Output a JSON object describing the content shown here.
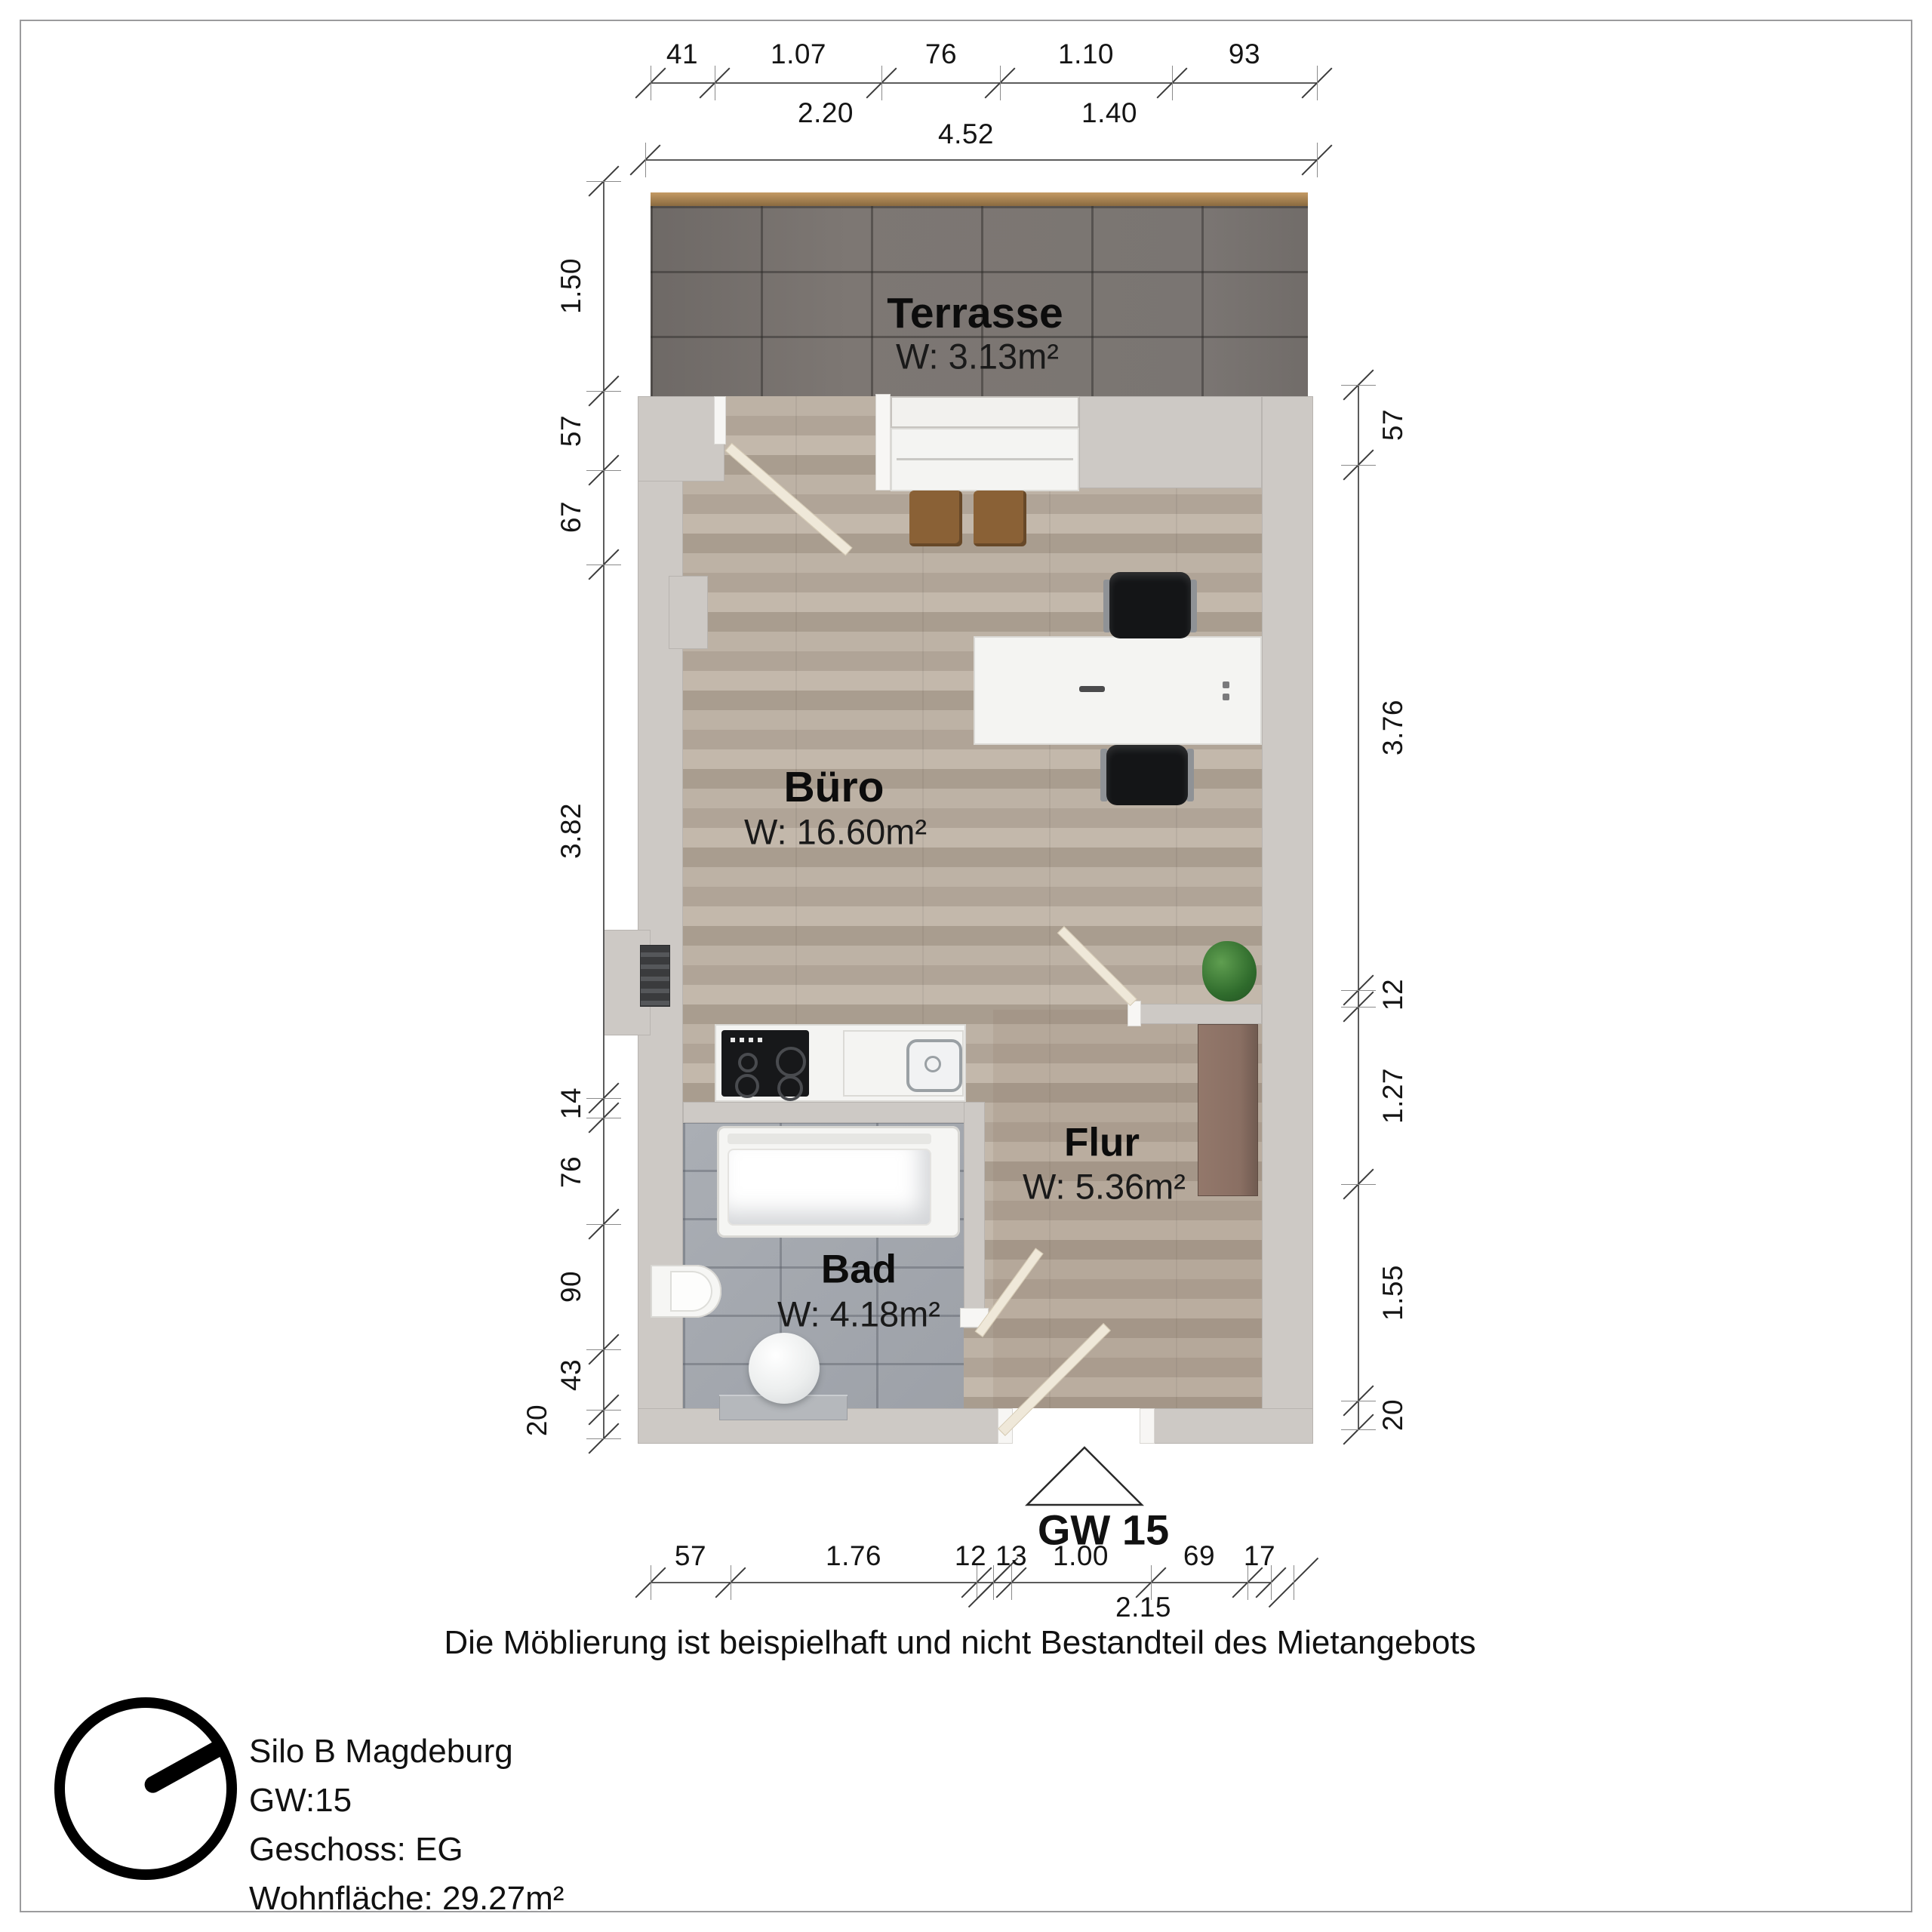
{
  "plan": {
    "unit_label": "GW 15",
    "rooms": {
      "terrasse": {
        "name": "Terrasse",
        "area": "W: 3.13m²"
      },
      "buero": {
        "name": "Büro",
        "area": "W: 16.60m²"
      },
      "flur": {
        "name": "Flur",
        "area": "W: 5.36m²"
      },
      "bad": {
        "name": "Bad",
        "area": "W: 4.18m²"
      }
    }
  },
  "dimensions": {
    "top_row1": [
      "41",
      "1.07",
      "76",
      "1.10",
      "93"
    ],
    "top_row2": [
      "2.20",
      "1.40"
    ],
    "top_total": "4.52",
    "left": [
      "1.50",
      "57",
      "67",
      "3.82",
      "14",
      "76",
      "90",
      "43",
      "20"
    ],
    "right": [
      "57",
      "3.76",
      "12",
      "1.27",
      "1.55",
      "20"
    ],
    "bottom": [
      "57",
      "1.76",
      "12",
      "13",
      "1.00",
      "69",
      "17"
    ],
    "bottom_total": "2.15"
  },
  "caption": "Die Möblierung ist beispielhaft und nicht Bestandteil des Mietangebots",
  "info": {
    "line1": "Silo B Magdeburg",
    "line2": "GW:15",
    "line3": "Geschoss: EG",
    "line4": "Wohnfläche: 29.27m²"
  },
  "icons": {
    "north": "north-arrow",
    "entrance": "entrance-triangle"
  }
}
